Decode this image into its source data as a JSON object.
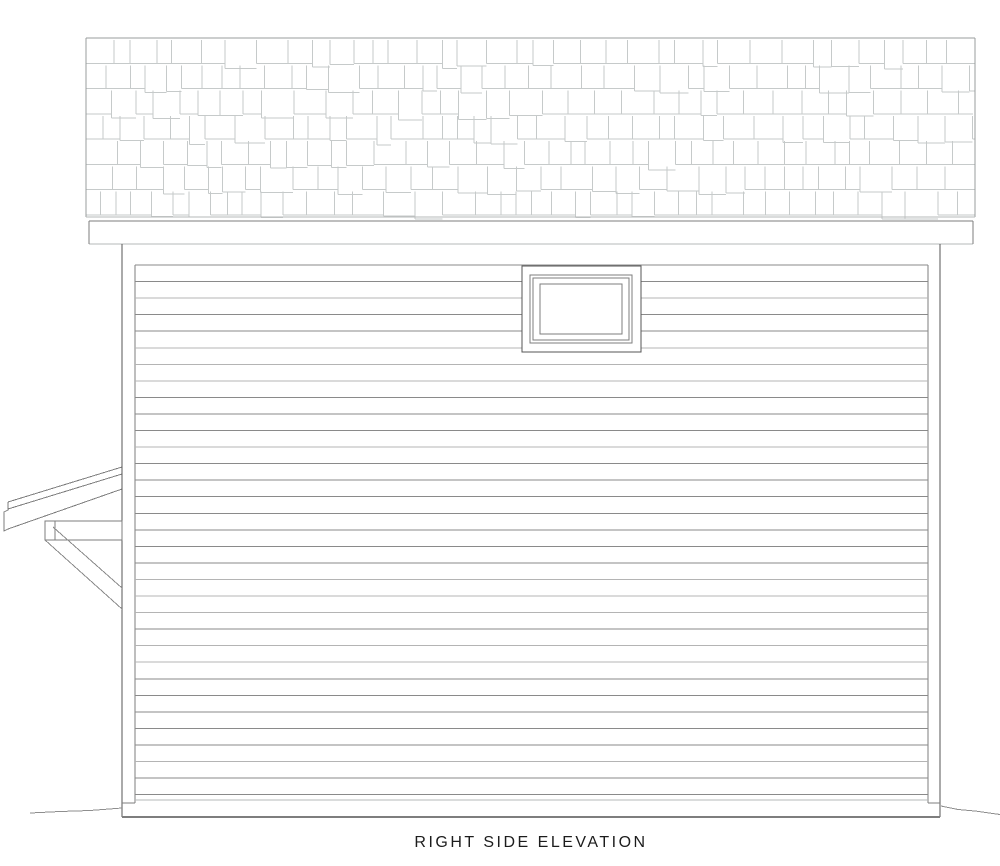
{
  "title": "RIGHT SIDE ELEVATION",
  "colors": {
    "background": "#ffffff",
    "outline_dark": "#555555",
    "outline_medium": "#7e7e7e",
    "outline_light": "#b5b8b8",
    "shingle_line": "#c6caca",
    "roof_edge": "#989c9c",
    "siding_dark": "#8a8a8a",
    "siding_light": "#b4b4b4",
    "ground": "#8e8e8e",
    "text": "#1c1c1c"
  },
  "drawing": {
    "canvas": {
      "width": 1000,
      "height": 866
    },
    "roof": {
      "left": 86,
      "top": 38,
      "right": 975,
      "shingle_bottom": 215,
      "rows": 7,
      "drip_y": 217,
      "min_shingle_w": 14,
      "max_shingle_w": 33,
      "drop_chance": 0.3,
      "max_drop": 5
    },
    "fascia": {
      "left": 89,
      "top": 221,
      "right": 973,
      "bottom": 244
    },
    "wall": {
      "left": 122,
      "right": 940,
      "top": 244,
      "bottom": 817,
      "trim_inner_left": 135,
      "trim_inner_right": 928,
      "trim_top": 265,
      "trim_bottom": 803,
      "skirt_line_y": 800
    },
    "siding": {
      "first_y": 265,
      "spacing": 16.55,
      "count": 33,
      "light_chance": 0.3
    },
    "window": {
      "outer": {
        "x": 522,
        "y": 266,
        "w": 119,
        "h": 86
      },
      "frame": {
        "x": 530,
        "y": 275,
        "w": 102,
        "h": 68
      },
      "frame_inner": {
        "x": 533,
        "y": 278,
        "w": 96,
        "h": 62
      },
      "glass": {
        "x": 540,
        "y": 284,
        "w": 82,
        "h": 50
      }
    },
    "awning": {
      "fascia_lines": [
        [
          8,
          502,
          122,
          467
        ],
        [
          8,
          509,
          122,
          474
        ],
        [
          8,
          529,
          122,
          489
        ]
      ],
      "fascia_end_cap": [
        [
          8,
          502
        ],
        [
          8,
          510
        ],
        [
          4,
          512
        ],
        [
          4,
          531
        ],
        [
          8,
          529
        ]
      ],
      "beam": {
        "x": 45,
        "y": 521,
        "w": 77,
        "h": 19,
        "cap_x": 55
      },
      "brace_lines": [
        [
          53,
          527,
          122,
          588
        ],
        [
          45,
          540,
          122,
          609
        ]
      ]
    },
    "ground_left": [
      [
        30,
        813
      ],
      [
        60,
        811.5
      ],
      [
        90,
        810.5
      ],
      [
        122,
        808
      ]
    ],
    "ground_right": [
      [
        941,
        806
      ],
      [
        958,
        809.5
      ],
      [
        975,
        811
      ],
      [
        1000,
        814.5
      ]
    ]
  }
}
